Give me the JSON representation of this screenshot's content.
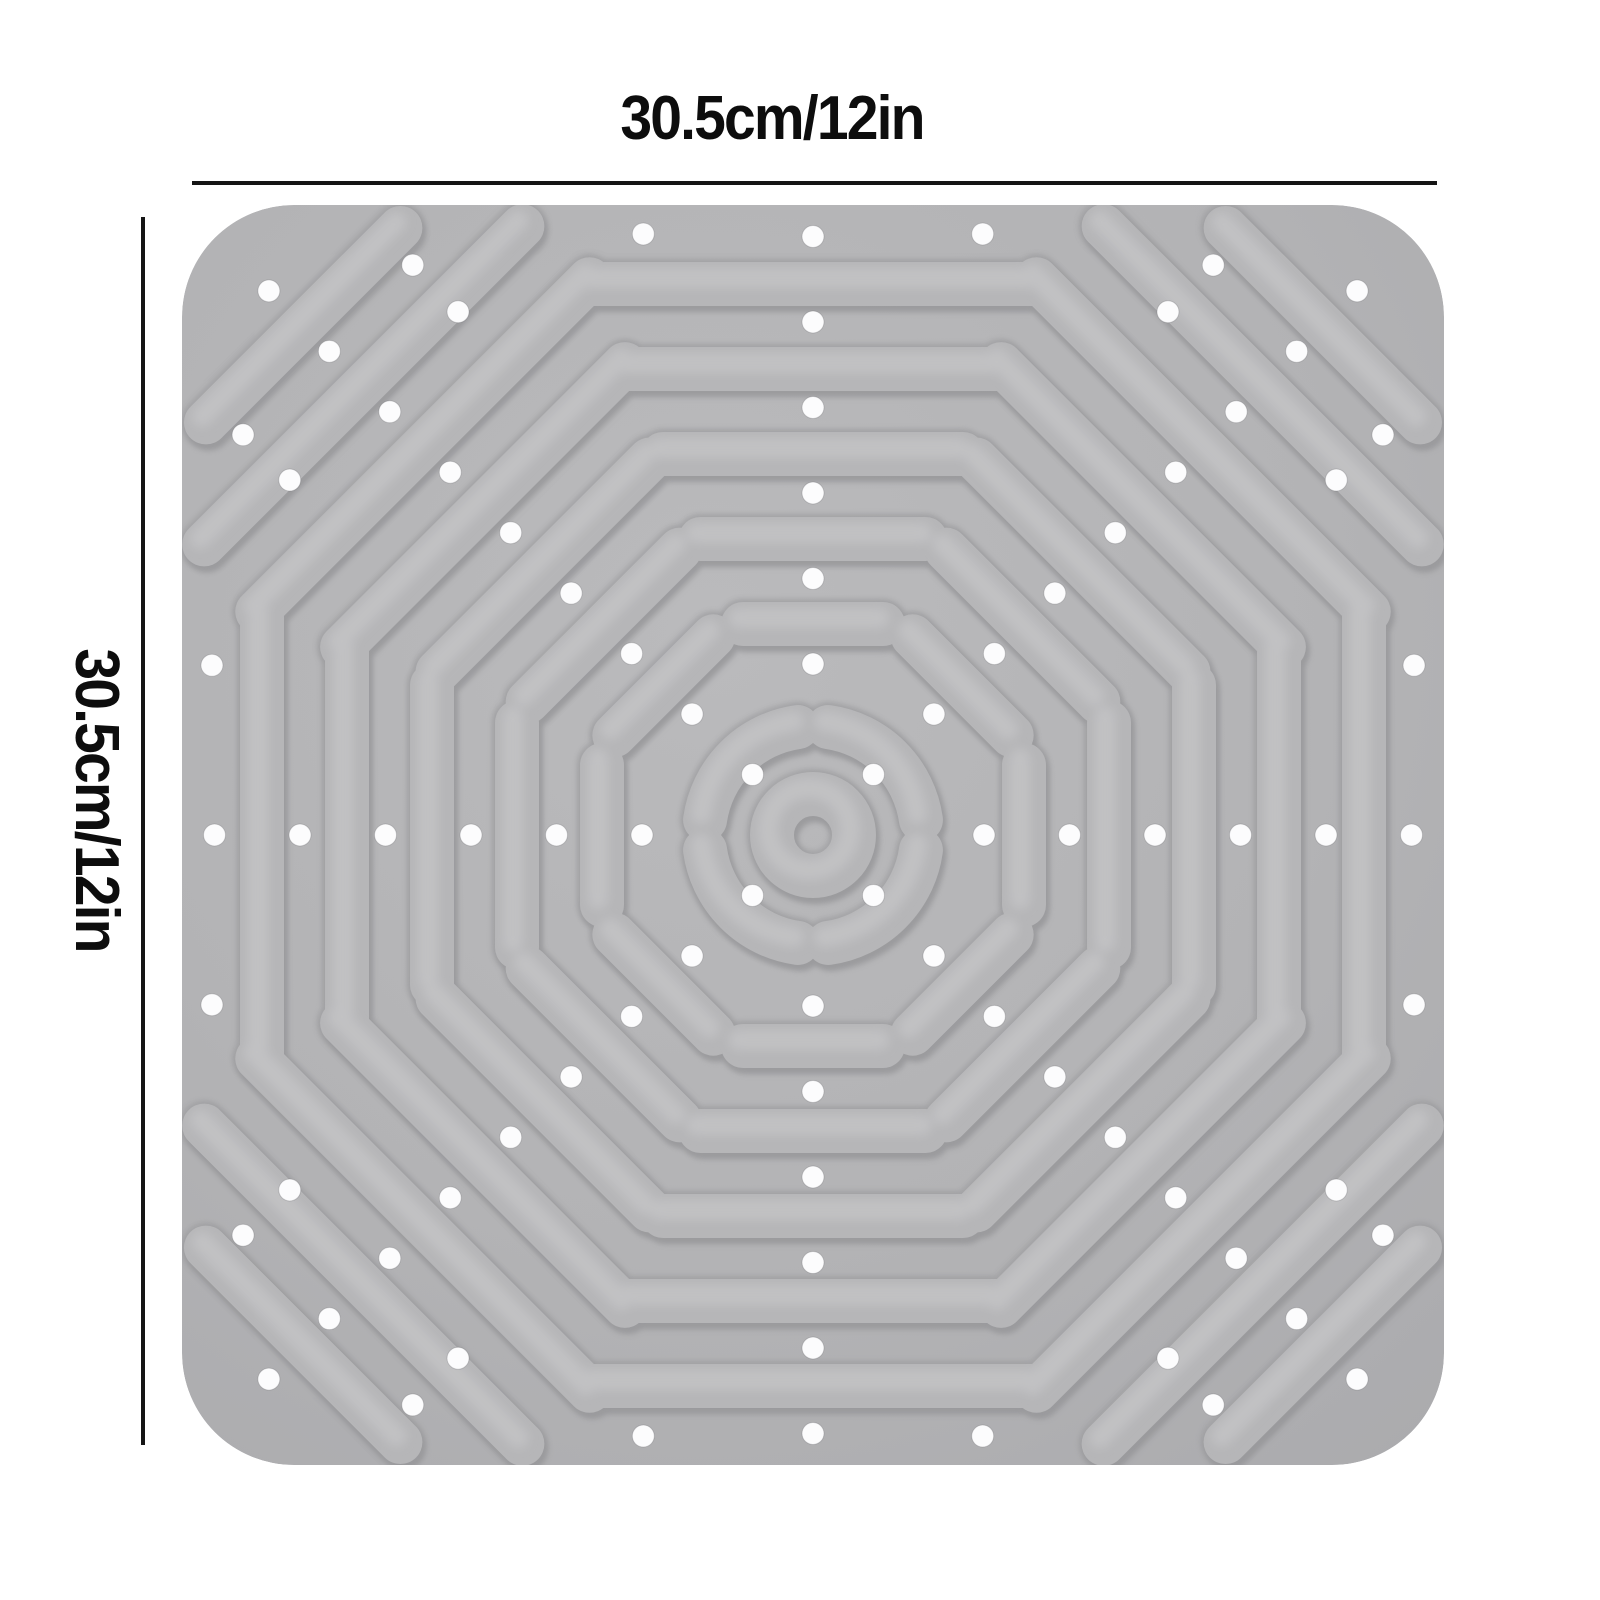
{
  "page": {
    "background_color": "#ffffff"
  },
  "dimensions": {
    "width_label": "30.5cm/12in",
    "height_label": "30.5cm/12in",
    "line_color": "#151515",
    "line_width": 4,
    "label_color": "#0d0d0d",
    "label_font_size": 62,
    "top_line": {
      "x1": 192,
      "y": 183,
      "x2": 1437
    },
    "left_line": {
      "x": 143,
      "y1": 217,
      "y2": 1445
    }
  },
  "mat": {
    "x": 182,
    "y": 205,
    "width": 1262,
    "height": 1260,
    "corner_radius": 112,
    "center": {
      "x": 813,
      "y": 835
    },
    "bar_thickness": 44,
    "colors": {
      "base": "#b3b3b5",
      "base_light": "#bbbbbd",
      "base_dark": "#a8a8ab",
      "bar": "#b6b6b8",
      "bar_outline": "#9b9b9e",
      "bar_shadow": "#8b8b8e",
      "bar_highlight": "#c9c9cb",
      "dot": "#fcfcfd"
    },
    "rings": [
      {
        "apothem": 211,
        "side": 140,
        "diagonal_side": 140
      },
      {
        "apothem": 296,
        "side": 225,
        "diagonal_side": 215
      },
      {
        "apothem": 381,
        "side": 300,
        "diagonal_side": 300
      },
      {
        "apothem": 466,
        "side": 370,
        "diagonal_side": 400
      },
      {
        "apothem": 551,
        "side": 440,
        "diagonal_side": 470
      }
    ],
    "corner_bars": [
      {
        "distance": 636,
        "length": 450
      },
      {
        "distance": 721,
        "length": 275
      }
    ],
    "arc_ring": {
      "radius": 109,
      "span_deg": 74
    },
    "donut": {
      "radius": 41
    },
    "dots": {
      "radius": 11,
      "step": 85.5,
      "diagonal_steps": [
        1,
        2,
        3,
        4,
        5,
        6,
        7,
        8,
        9
      ],
      "axis_steps": [
        2,
        3,
        4,
        5,
        6,
        7
      ],
      "corner_extras": [
        [
          545,
          -305
        ],
        [
          545,
          305
        ],
        [
          621,
          -119
        ],
        [
          621,
          119
        ],
        [
          686,
          -120
        ],
        [
          686,
          120
        ]
      ]
    }
  }
}
